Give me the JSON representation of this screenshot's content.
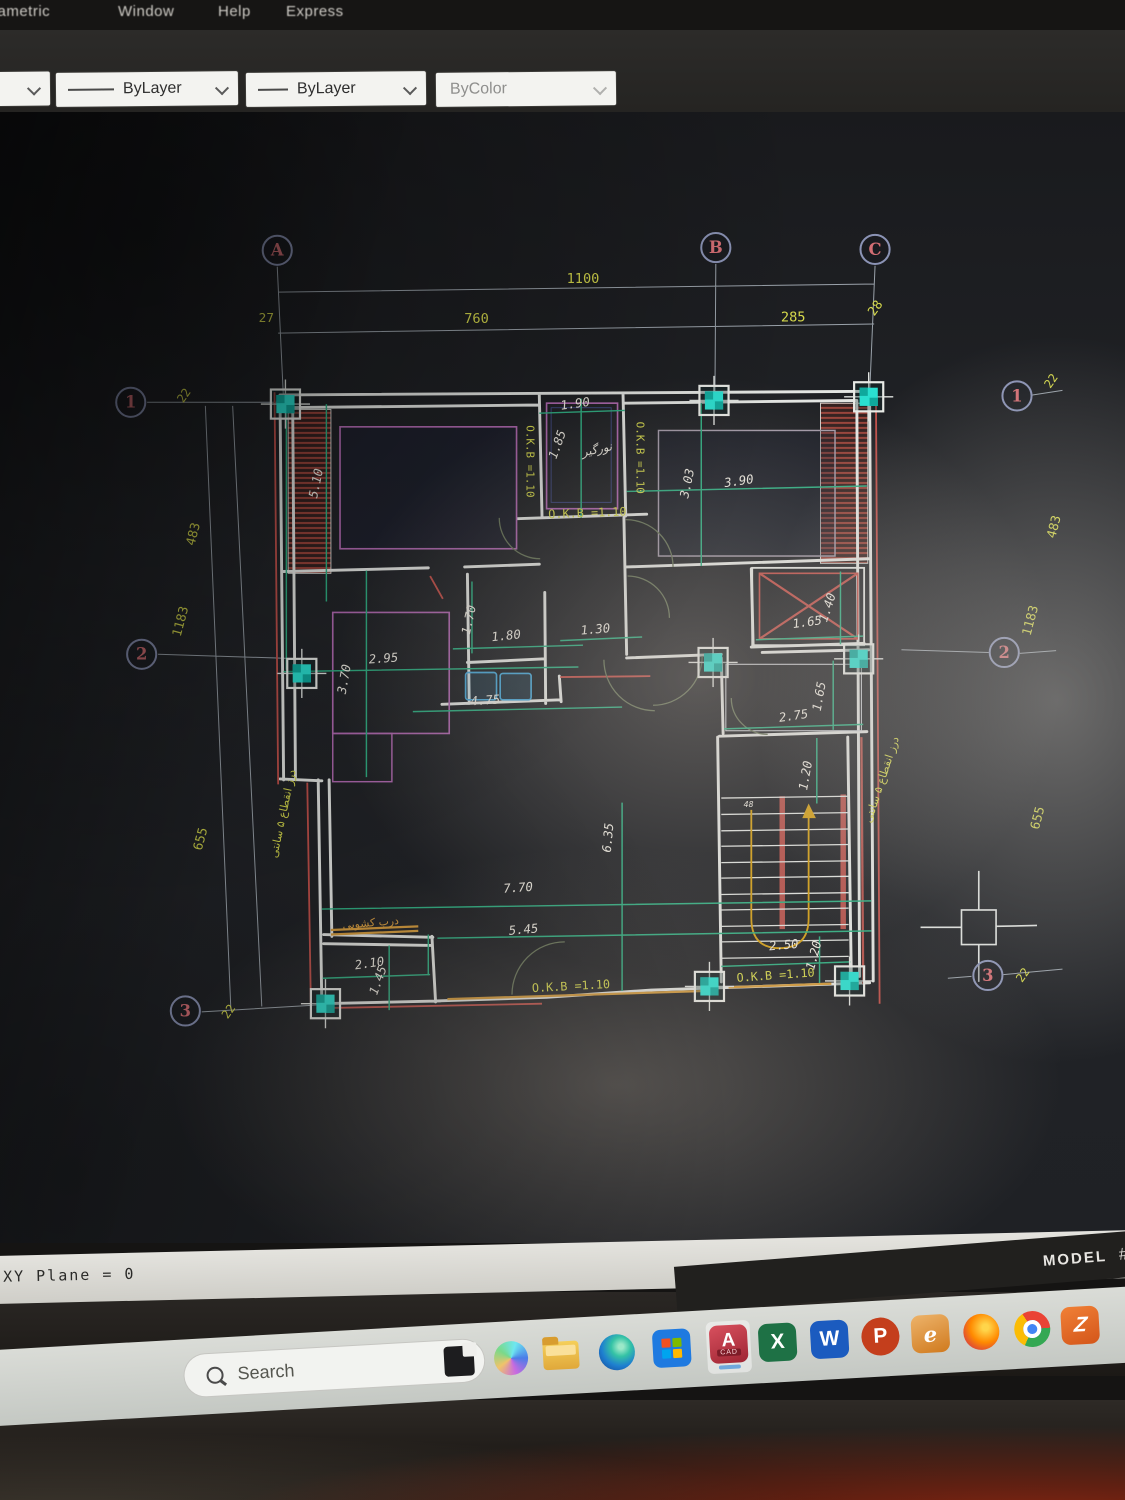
{
  "window": {
    "menu_items": [
      "rametric",
      "Window",
      "Help",
      "Express"
    ]
  },
  "toolbar": {
    "layer_combo_value": "ByLayer",
    "linetype_combo_value": "ByLayer",
    "plotstyle_combo_value": "ByColor"
  },
  "statusbar": {
    "command_text": "XY Plane = 0",
    "model_label": "MODEL",
    "model_suffix": "#"
  },
  "taskbar": {
    "search_placeholder": "Search",
    "autocad_letter": "A",
    "autocad_sub": "CAD",
    "excel_letter": "X",
    "word_letter": "W",
    "powerpoint_letter": "P",
    "eitaa_letter": "e",
    "zapp_letter": "Z",
    "icons": [
      "windows-start",
      "search",
      "task-view",
      "copilot",
      "file-explorer",
      "edge",
      "microsoft-store",
      "autocad",
      "excel",
      "word",
      "powerpoint",
      "eitaa",
      "firefox",
      "chrome",
      "z-app"
    ]
  },
  "colors": {
    "dim_yellow": "#d6d94c",
    "dim_white": "#ece9e0",
    "dim_orange": "#dca040",
    "grid_cyan": "#2adfd0",
    "wall_white": "#e3e5e2",
    "hatch_red": "#a5473d",
    "green": "#2fae82",
    "magenta": "#b069b0",
    "bubble_ring": "#8b93b5",
    "bubble_text": "#d46e74"
  },
  "drawing": {
    "grid_bubbles": [
      {
        "label": "A",
        "x": 249,
        "y": 264
      },
      {
        "label": "B",
        "x": 731,
        "y": 261
      },
      {
        "label": "C",
        "x": 906,
        "y": 263
      },
      {
        "label": "1",
        "x": 88,
        "y": 431
      },
      {
        "label": "2",
        "x": 100,
        "y": 708
      },
      {
        "label": "3",
        "x": 148,
        "y": 1100
      },
      {
        "label": "1",
        "x": 1062,
        "y": 424
      },
      {
        "label": "2",
        "x": 1048,
        "y": 706
      },
      {
        "label": "3",
        "x": 1030,
        "y": 1061
      }
    ],
    "columns": [
      {
        "x": 258,
        "y": 433
      },
      {
        "x": 729,
        "y": 429
      },
      {
        "x": 899,
        "y": 425
      },
      {
        "x": 276,
        "y": 729
      },
      {
        "x": 728,
        "y": 717
      },
      {
        "x": 888,
        "y": 713
      },
      {
        "x": 302,
        "y": 1092
      },
      {
        "x": 724,
        "y": 1073
      },
      {
        "x": 878,
        "y": 1067
      }
    ],
    "dimensions": [
      {
        "t": "1100",
        "x": 585,
        "y": 300,
        "r": 0,
        "c": "y",
        "s": 15
      },
      {
        "t": "760",
        "x": 468,
        "y": 344,
        "r": 0,
        "c": "y",
        "s": 15
      },
      {
        "t": "27",
        "x": 237,
        "y": 343,
        "r": 0,
        "c": "y",
        "s": 14
      },
      {
        "t": "285",
        "x": 816,
        "y": 342,
        "r": 0,
        "c": "y",
        "s": 15
      },
      {
        "t": "28",
        "x": 910,
        "y": 330,
        "r": -55,
        "c": "y",
        "s": 14
      },
      {
        "t": "22",
        "x": 150,
        "y": 426,
        "r": -55,
        "c": "y",
        "s": 13
      },
      {
        "t": "483",
        "x": 161,
        "y": 577,
        "r": -75,
        "c": "y",
        "s": 14
      },
      {
        "t": "1183",
        "x": 147,
        "y": 673,
        "r": -75,
        "c": "y",
        "s": 14
      },
      {
        "t": "655",
        "x": 169,
        "y": 912,
        "r": -75,
        "c": "y",
        "s": 14
      },
      {
        "t": "22",
        "x": 199,
        "y": 1103,
        "r": -55,
        "c": "y",
        "s": 13
      },
      {
        "t": "22",
        "x": 1103,
        "y": 410,
        "r": -55,
        "c": "y",
        "s": 13
      },
      {
        "t": "483",
        "x": 1107,
        "y": 569,
        "r": -75,
        "c": "y",
        "s": 14
      },
      {
        "t": "1183",
        "x": 1081,
        "y": 672,
        "r": -75,
        "c": "y",
        "s": 14
      },
      {
        "t": "655",
        "x": 1089,
        "y": 889,
        "r": -75,
        "c": "y",
        "s": 14
      },
      {
        "t": "22",
        "x": 1072,
        "y": 1063,
        "r": -55,
        "c": "y",
        "s": 13
      },
      {
        "t": "5.10",
        "x": 296,
        "y": 521,
        "r": -78,
        "c": "w"
      },
      {
        "t": "1.90",
        "x": 577,
        "y": 437,
        "r": -8,
        "c": "w"
      },
      {
        "t": "1.85",
        "x": 561,
        "y": 479,
        "r": -70,
        "c": "w"
      },
      {
        "t": "3.03",
        "x": 704,
        "y": 521,
        "r": -78,
        "c": "w"
      },
      {
        "t": "3.90",
        "x": 757,
        "y": 522,
        "r": -8,
        "c": "w"
      },
      {
        "t": "1.70",
        "x": 464,
        "y": 671,
        "r": -78,
        "c": "w"
      },
      {
        "t": "1.80",
        "x": 501,
        "y": 692,
        "r": -6,
        "c": "w"
      },
      {
        "t": "2.95",
        "x": 366,
        "y": 717,
        "r": -4,
        "c": "w"
      },
      {
        "t": "3.70",
        "x": 327,
        "y": 736,
        "r": -80,
        "c": "w"
      },
      {
        "t": "4.75",
        "x": 478,
        "y": 763,
        "r": -4,
        "c": "w"
      },
      {
        "t": "1.30",
        "x": 599,
        "y": 685,
        "r": -5,
        "c": "w"
      },
      {
        "t": "1.65",
        "x": 832,
        "y": 677,
        "r": -8,
        "c": "w"
      },
      {
        "t": "1.40",
        "x": 858,
        "y": 658,
        "r": -72,
        "c": "w"
      },
      {
        "t": "2.75",
        "x": 817,
        "y": 780,
        "r": -8,
        "c": "w"
      },
      {
        "t": "1.65",
        "x": 849,
        "y": 755,
        "r": -80,
        "c": "w"
      },
      {
        "t": "1.20",
        "x": 834,
        "y": 842,
        "r": -80,
        "c": "w"
      },
      {
        "t": "48",
        "x": 767,
        "y": 876,
        "r": 0,
        "c": "w",
        "s": 9
      },
      {
        "t": "2.50",
        "x": 806,
        "y": 1032,
        "r": -5,
        "c": "w"
      },
      {
        "t": "1.20",
        "x": 843,
        "y": 1040,
        "r": -75,
        "c": "w"
      },
      {
        "t": "7.70",
        "x": 514,
        "y": 969,
        "r": -4,
        "c": "w"
      },
      {
        "t": "5.45",
        "x": 520,
        "y": 1015,
        "r": -5,
        "c": "w"
      },
      {
        "t": "2.10",
        "x": 351,
        "y": 1052,
        "r": -8,
        "c": "w"
      },
      {
        "t": "1.45",
        "x": 364,
        "y": 1068,
        "r": -70,
        "c": "w"
      },
      {
        "t": "6.35",
        "x": 617,
        "y": 910,
        "r": -85,
        "c": "w"
      },
      {
        "t": "O.K.B =1.10",
        "x": 523,
        "y": 496,
        "r": 90,
        "c": "y",
        "s": 12
      },
      {
        "t": "O.K.B =1.10",
        "x": 644,
        "y": 492,
        "r": 90,
        "c": "y",
        "s": 12
      },
      {
        "t": "O.K.B =1.10",
        "x": 590,
        "y": 557,
        "r": -2,
        "c": "y",
        "s": 13
      },
      {
        "t": "O.K.B =1.10",
        "x": 572,
        "y": 1077,
        "r": -3,
        "c": "y",
        "s": 13
      },
      {
        "t": "O.K.B =1.10",
        "x": 797,
        "y": 1065,
        "r": -4,
        "c": "y",
        "s": 13
      },
      {
        "t": "نورگیر",
        "x": 601,
        "y": 487,
        "r": -12,
        "c": "w",
        "s": 13
      },
      {
        "t": "درب کشویی",
        "x": 352,
        "y": 1007,
        "r": -5,
        "c": "o",
        "s": 12
      },
      {
        "t": "درز انقطاع ۵ سانتی",
        "x": 259,
        "y": 884,
        "r": -78,
        "c": "y",
        "s": 12
      },
      {
        "t": "درز انقطاع ۵ سانتی",
        "x": 917,
        "y": 847,
        "r": -72,
        "c": "y",
        "s": 12
      }
    ]
  }
}
